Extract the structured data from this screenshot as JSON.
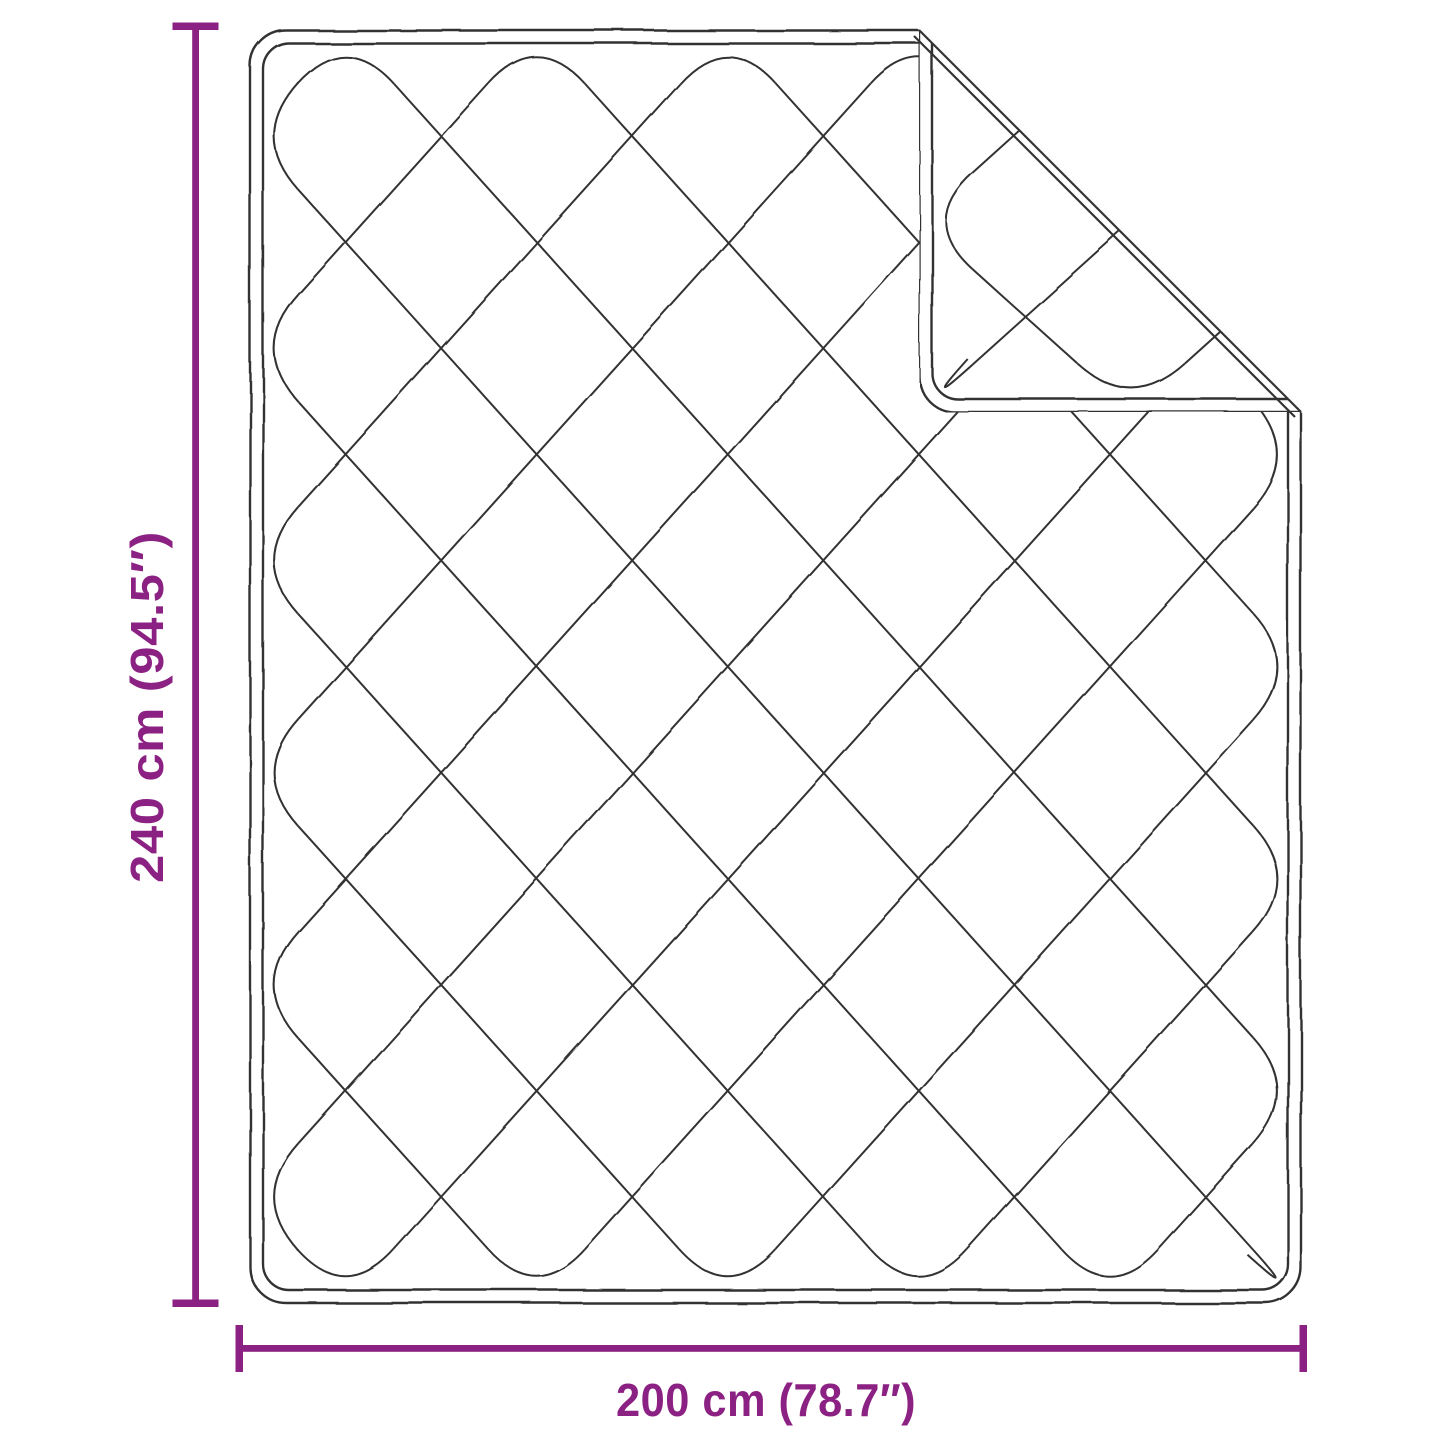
{
  "dimensions": {
    "height": {
      "label": "240 cm (94.5″)"
    },
    "width": {
      "label": "200 cm (78.7″)"
    }
  },
  "colors": {
    "accent": "#8B2182",
    "line": "#333333",
    "background": "#FFFFFF"
  }
}
